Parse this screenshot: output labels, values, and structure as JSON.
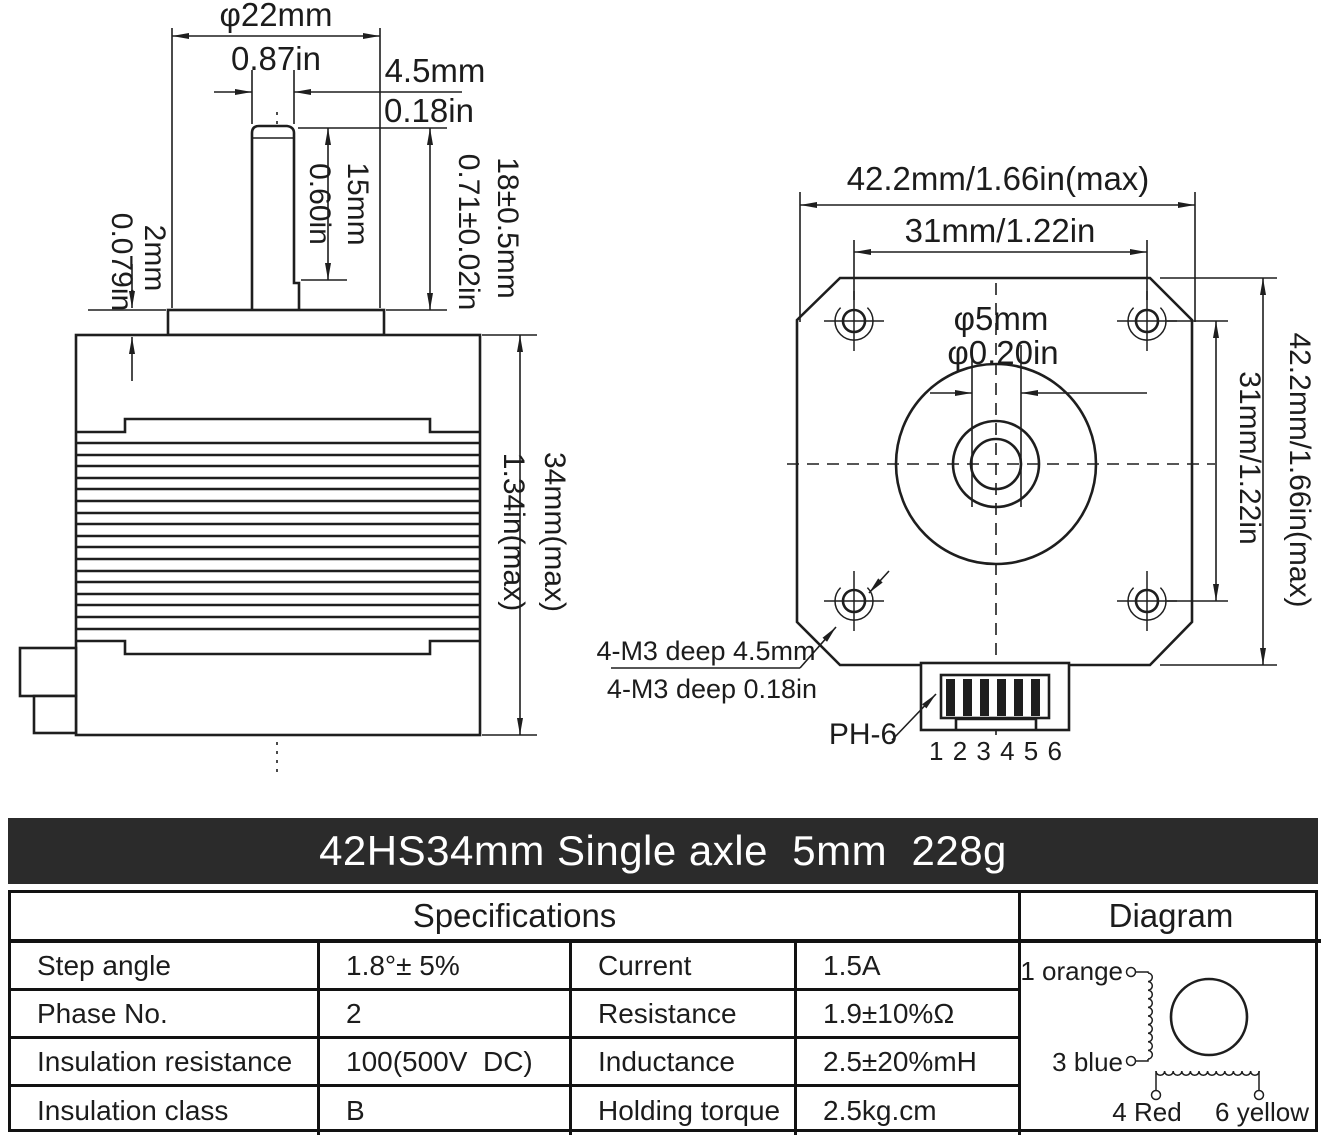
{
  "title": "42HS34mm Single axle  5mm  228g",
  "side_view": {
    "phi22_mm": "φ22mm",
    "phi22_in": "0.87in",
    "flat_mm": "4.5mm",
    "flat_in": "0.18in",
    "flat_len_mm": "15mm",
    "flat_len_in": "0.60in",
    "shaft_len_mm": "18±0.5mm",
    "shaft_len_in": "0.71±0.02in",
    "boss_mm": "2mm",
    "boss_in": "0.079in",
    "body_len_mm": "34mm(max)",
    "body_len_in": "1.34in(max)"
  },
  "front_view": {
    "width_mm_in": "42.2mm/1.66in(max)",
    "hole_span_mm_in": "31mm/1.22in",
    "shaft_dia_mm": "φ5mm",
    "shaft_dia_in": "φ0.20in",
    "hole_span_v_mm_in": "31mm/1.22in",
    "height_mm_in": "42.2mm/1.66in(max)",
    "mount_note_mm": "4-M3 deep 4.5mm",
    "mount_note_in": "4-M3 deep 0.18in",
    "connector_label": "PH-6",
    "pin_numbers": "1 2 3 4 5 6"
  },
  "table": {
    "spec_header": "Specifications",
    "diagram_header": "Diagram",
    "rows": [
      {
        "label1": "Step angle",
        "value1": "1.8°± 5%",
        "label2": "Current",
        "value2": "1.5A"
      },
      {
        "label1": "Phase No.",
        "value1": "2",
        "label2": "Resistance",
        "value2": "1.9±10%Ω"
      },
      {
        "label1": "Insulation resistance",
        "value1": "100(500V  DC)",
        "label2": "Inductance",
        "value2": "2.5±20%mH"
      },
      {
        "label1": "Insulation class",
        "value1": "B",
        "label2": "Holding torque",
        "value2": "2.5kg.cm"
      }
    ]
  },
  "wiring": {
    "t1": "1 orange",
    "t3": "3 blue",
    "t4": "4 Red",
    "t6": "6 yellow"
  }
}
